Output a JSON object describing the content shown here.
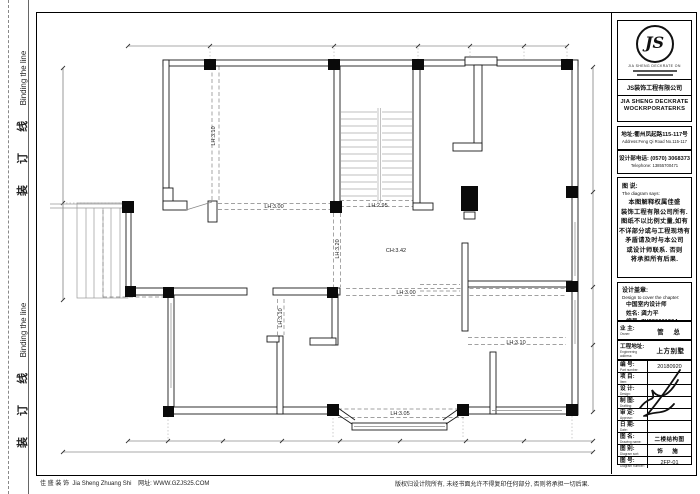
{
  "binding": {
    "cn": "装 订 线",
    "en": "Binding the line"
  },
  "footer": {
    "left_cn": "佳 盛 装 饰",
    "left_en": "Jia Sheng Zhuang Shi",
    "left_web": "网址: WWW.GZJS25.COM",
    "right": "版权归设计院所有, 未经书面允许不得复印任何部分, 否则将承担一切后果."
  },
  "title_block": {
    "logo": {
      "monogram": "JS",
      "ring_text": "JIA SHENG DECKRATE ON",
      "company_cn": "JS装饰工程有限公司",
      "company_en1": "JIA SHENG DECKRATE",
      "company_en2": "WOCKRPORATERKS"
    },
    "address": {
      "cn": "地址:衢州凤起路115-117号",
      "en": "Address:Feng Qi Road No.115-117"
    },
    "phone": {
      "cn": "设计部电话: (0570) 3068373",
      "en": "Telephone: 13855700471"
    },
    "note": {
      "label_cn": "图 说:",
      "label_en": "The diagram says:",
      "lines": [
        "本图解释权属佳盛",
        "装饰工程有限公司所有.",
        "图纸不以比例丈量,如有",
        "不详部分或与工程现场有",
        "矛盾请及时与本公司",
        "或设计师联系. 否则",
        "将承担所有后果."
      ]
    },
    "seal": {
      "label_cn": "设计盖章:",
      "label_en": "Design to cover the chapter:",
      "line1": "中国室内设计师",
      "line2": "姓名: 龚力平",
      "line3": "编号: ZY220601904"
    },
    "rows": [
      {
        "cn": "业 主:",
        "en": "Owner:",
        "value": "管 总"
      },
      {
        "cn": "工程地址:",
        "en": "Engineering address:",
        "value": "上方别墅"
      },
      {
        "cn": "编 号:",
        "en": "Part number:",
        "value": "20180920"
      },
      {
        "cn": "项 目:",
        "en": "Item:",
        "value": ""
      },
      {
        "cn": "设 计:",
        "en": "Design:",
        "value": ""
      },
      {
        "cn": "制 图:",
        "en": "Drafting:",
        "value": ""
      },
      {
        "cn": "审 定:",
        "en": "Approve:",
        "value": ""
      },
      {
        "cn": "日 期:",
        "en": "Date:",
        "value": ""
      },
      {
        "cn": "图 名:",
        "en": "Drawing name:",
        "value": "二楼结构图"
      },
      {
        "cn": "图 别:",
        "en": "Diagram sort:",
        "value": "饰 施"
      },
      {
        "cn": "图 号:",
        "en": "Diagram number:",
        "value": "2FP-01"
      }
    ]
  },
  "plan": {
    "labels": [
      "LH:3.10",
      "LH:3.00",
      "LH:2.95",
      "CH:3.42",
      "LH:3.20",
      "LH:3.00",
      "LH:3.10",
      "LH:3.10",
      "LH:3.05"
    ]
  }
}
